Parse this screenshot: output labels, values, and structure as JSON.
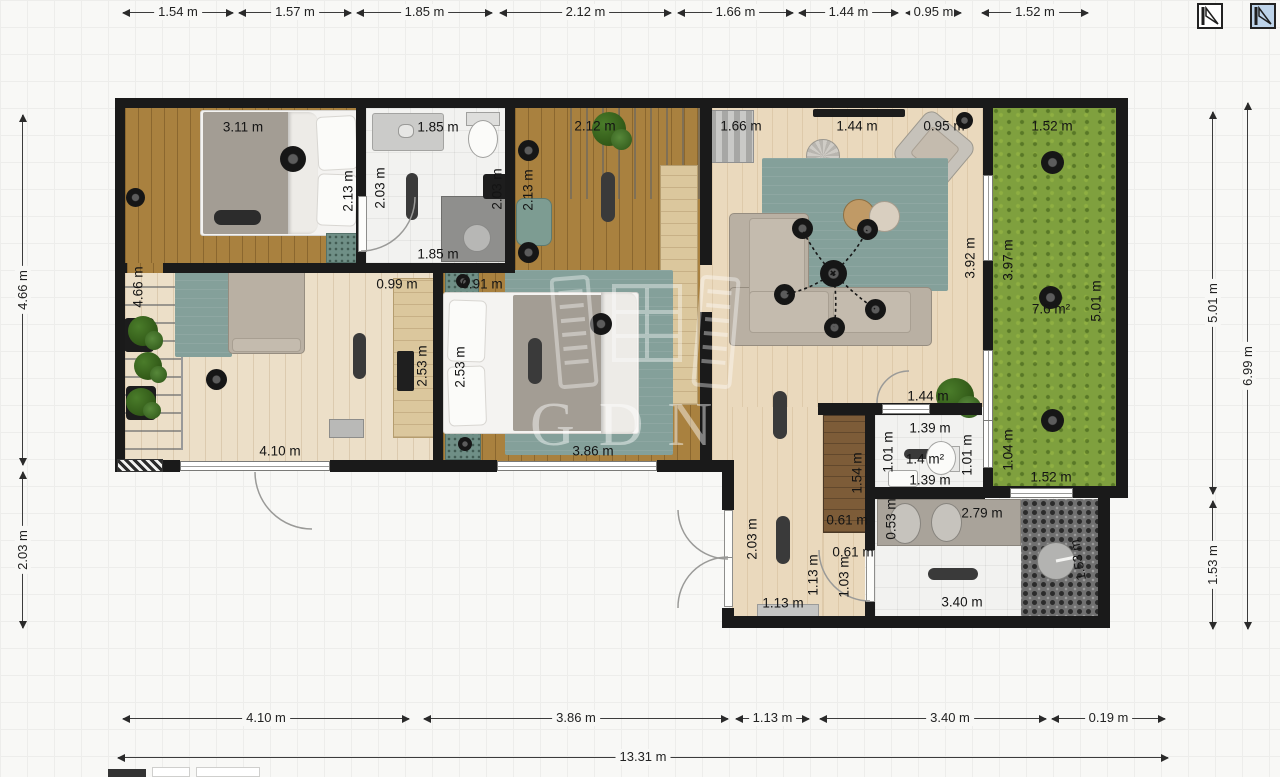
{
  "app": {
    "watermark_text": "GDN",
    "floor_selector": [
      {
        "name": "floor-icon-1",
        "selected": false
      },
      {
        "name": "floor-icon-2",
        "selected": true
      }
    ]
  },
  "colors": {
    "background": "#f8f8f6",
    "wall": "#1a1a1a",
    "grass": "#7fa03e",
    "wood_dark": "#a9813f",
    "wood_light": "#ead9bd",
    "rug_teal": "#84a09a",
    "selected_icon_bg": "#bdd3e9"
  },
  "dimensions": {
    "top": {
      "y": 12,
      "segments": [
        {
          "label": "1.54 m",
          "x1": 123,
          "x2": 233
        },
        {
          "label": "1.57 m",
          "x1": 239,
          "x2": 351
        },
        {
          "label": "1.85 m",
          "x1": 357,
          "x2": 492
        },
        {
          "label": "2.12 m",
          "x1": 500,
          "x2": 671
        },
        {
          "label": "1.66 m",
          "x1": 678,
          "x2": 793
        },
        {
          "label": "1.44 m",
          "x1": 799,
          "x2": 898
        },
        {
          "label": "0.95 m",
          "x1": 906,
          "x2": 961
        },
        {
          "label": "1.52 m",
          "x1": 982,
          "x2": 1088
        }
      ]
    },
    "bottom": {
      "y": 718,
      "segments": [
        {
          "label": "4.10 m",
          "x1": 123,
          "x2": 409
        },
        {
          "label": "3.86 m",
          "x1": 424,
          "x2": 728
        },
        {
          "label": "1.13 m",
          "x1": 736,
          "x2": 809
        },
        {
          "label": "3.40 m",
          "x1": 820,
          "x2": 1046,
          "lx": 130
        },
        {
          "label": "0.19 m",
          "x1": 1052,
          "x2": 1165
        }
      ]
    },
    "total": {
      "y": 757,
      "segments": [
        {
          "label": "13.31 m",
          "x1": 118,
          "x2": 1168
        }
      ]
    },
    "left": {
      "x": 22,
      "segments": [
        {
          "label": "4.66 m",
          "y1": 115,
          "y2": 465
        },
        {
          "label": "2.03 m",
          "y1": 472,
          "y2": 628
        }
      ]
    },
    "right_inner": {
      "x": 1212,
      "segments": [
        {
          "label": "5.01 m",
          "y1": 112,
          "y2": 494
        },
        {
          "label": "1.53 m",
          "y1": 501,
          "y2": 629
        }
      ]
    },
    "right_outer": {
      "x": 1247,
      "segments": [
        {
          "label": "6.99 m",
          "y1": 103,
          "y2": 629
        }
      ]
    }
  },
  "plan_labels": [
    {
      "text": "3.11 m",
      "x": 243,
      "y": 127,
      "rot": 0
    },
    {
      "text": "2.13 m",
      "x": 348,
      "y": 191,
      "rot": -90
    },
    {
      "text": "1.85 m",
      "x": 438,
      "y": 127,
      "rot": 0
    },
    {
      "text": "2.03 m",
      "x": 380,
      "y": 188,
      "rot": -90
    },
    {
      "text": "1.85 m",
      "x": 438,
      "y": 254,
      "rot": 0
    },
    {
      "text": "2.03 m",
      "x": 497,
      "y": 189,
      "rot": -90
    },
    {
      "text": "2.12 m",
      "x": 595,
      "y": 126,
      "rot": 0
    },
    {
      "text": "2.13 m",
      "x": 528,
      "y": 190,
      "rot": -90
    },
    {
      "text": "1.66 m",
      "x": 741,
      "y": 126,
      "rot": 0
    },
    {
      "text": "1.44 m",
      "x": 857,
      "y": 126,
      "rot": 0
    },
    {
      "text": "0.95 m",
      "x": 944,
      "y": 126,
      "rot": 0
    },
    {
      "text": "3.92 m",
      "x": 970,
      "y": 258,
      "rot": -90
    },
    {
      "text": "1.52 m",
      "x": 1052,
      "y": 126,
      "rot": 0
    },
    {
      "text": "3.97 m",
      "x": 1008,
      "y": 260,
      "rot": -90
    },
    {
      "text": "5.01 m",
      "x": 1096,
      "y": 301,
      "rot": -90
    },
    {
      "text": "7.6 m²",
      "x": 1051,
      "y": 309,
      "rot": 0
    },
    {
      "text": "1.04 m",
      "x": 1008,
      "y": 450,
      "rot": -90
    },
    {
      "text": "1.52 m",
      "x": 1051,
      "y": 477,
      "rot": 0
    },
    {
      "text": "4.66 m",
      "x": 138,
      "y": 287,
      "rot": -90
    },
    {
      "text": "0.99 m",
      "x": 397,
      "y": 284,
      "rot": 0
    },
    {
      "text": "2.53 m",
      "x": 422,
      "y": 366,
      "rot": -90
    },
    {
      "text": "4.10 m",
      "x": 280,
      "y": 451,
      "rot": 0
    },
    {
      "text": "0.91 m",
      "x": 482,
      "y": 284,
      "rot": 0
    },
    {
      "text": "2.53 m",
      "x": 460,
      "y": 367,
      "rot": -90
    },
    {
      "text": "3.86 m",
      "x": 593,
      "y": 451,
      "rot": 0
    },
    {
      "text": "1.44 m",
      "x": 928,
      "y": 396,
      "rot": 0
    },
    {
      "text": "1.39 m",
      "x": 930,
      "y": 428,
      "rot": 0
    },
    {
      "text": "1.01 m",
      "x": 888,
      "y": 452,
      "rot": -90
    },
    {
      "text": "1.4 m²",
      "x": 925,
      "y": 459,
      "rot": 0
    },
    {
      "text": "1.01 m",
      "x": 967,
      "y": 455,
      "rot": -90
    },
    {
      "text": "1.39 m",
      "x": 930,
      "y": 480,
      "rot": 0
    },
    {
      "text": "1.54 m",
      "x": 857,
      "y": 473,
      "rot": -90
    },
    {
      "text": "0.61 m",
      "x": 847,
      "y": 520,
      "rot": 0
    },
    {
      "text": "2.03 m",
      "x": 752,
      "y": 539,
      "rot": -90
    },
    {
      "text": "0.61 m",
      "x": 853,
      "y": 552,
      "rot": 0
    },
    {
      "text": "0.53 m",
      "x": 891,
      "y": 519,
      "rot": -90
    },
    {
      "text": "2.79 m",
      "x": 982,
      "y": 513,
      "rot": 0
    },
    {
      "text": "1.03 m",
      "x": 844,
      "y": 577,
      "rot": -90
    },
    {
      "text": "1.13 m",
      "x": 813,
      "y": 575,
      "rot": -90
    },
    {
      "text": "1.13 m",
      "x": 783,
      "y": 603,
      "rot": 0
    },
    {
      "text": "3.40 m",
      "x": 962,
      "y": 602,
      "rot": 0
    },
    {
      "text": "1.53 m",
      "x": 1078,
      "y": 560,
      "rot": -100
    }
  ]
}
